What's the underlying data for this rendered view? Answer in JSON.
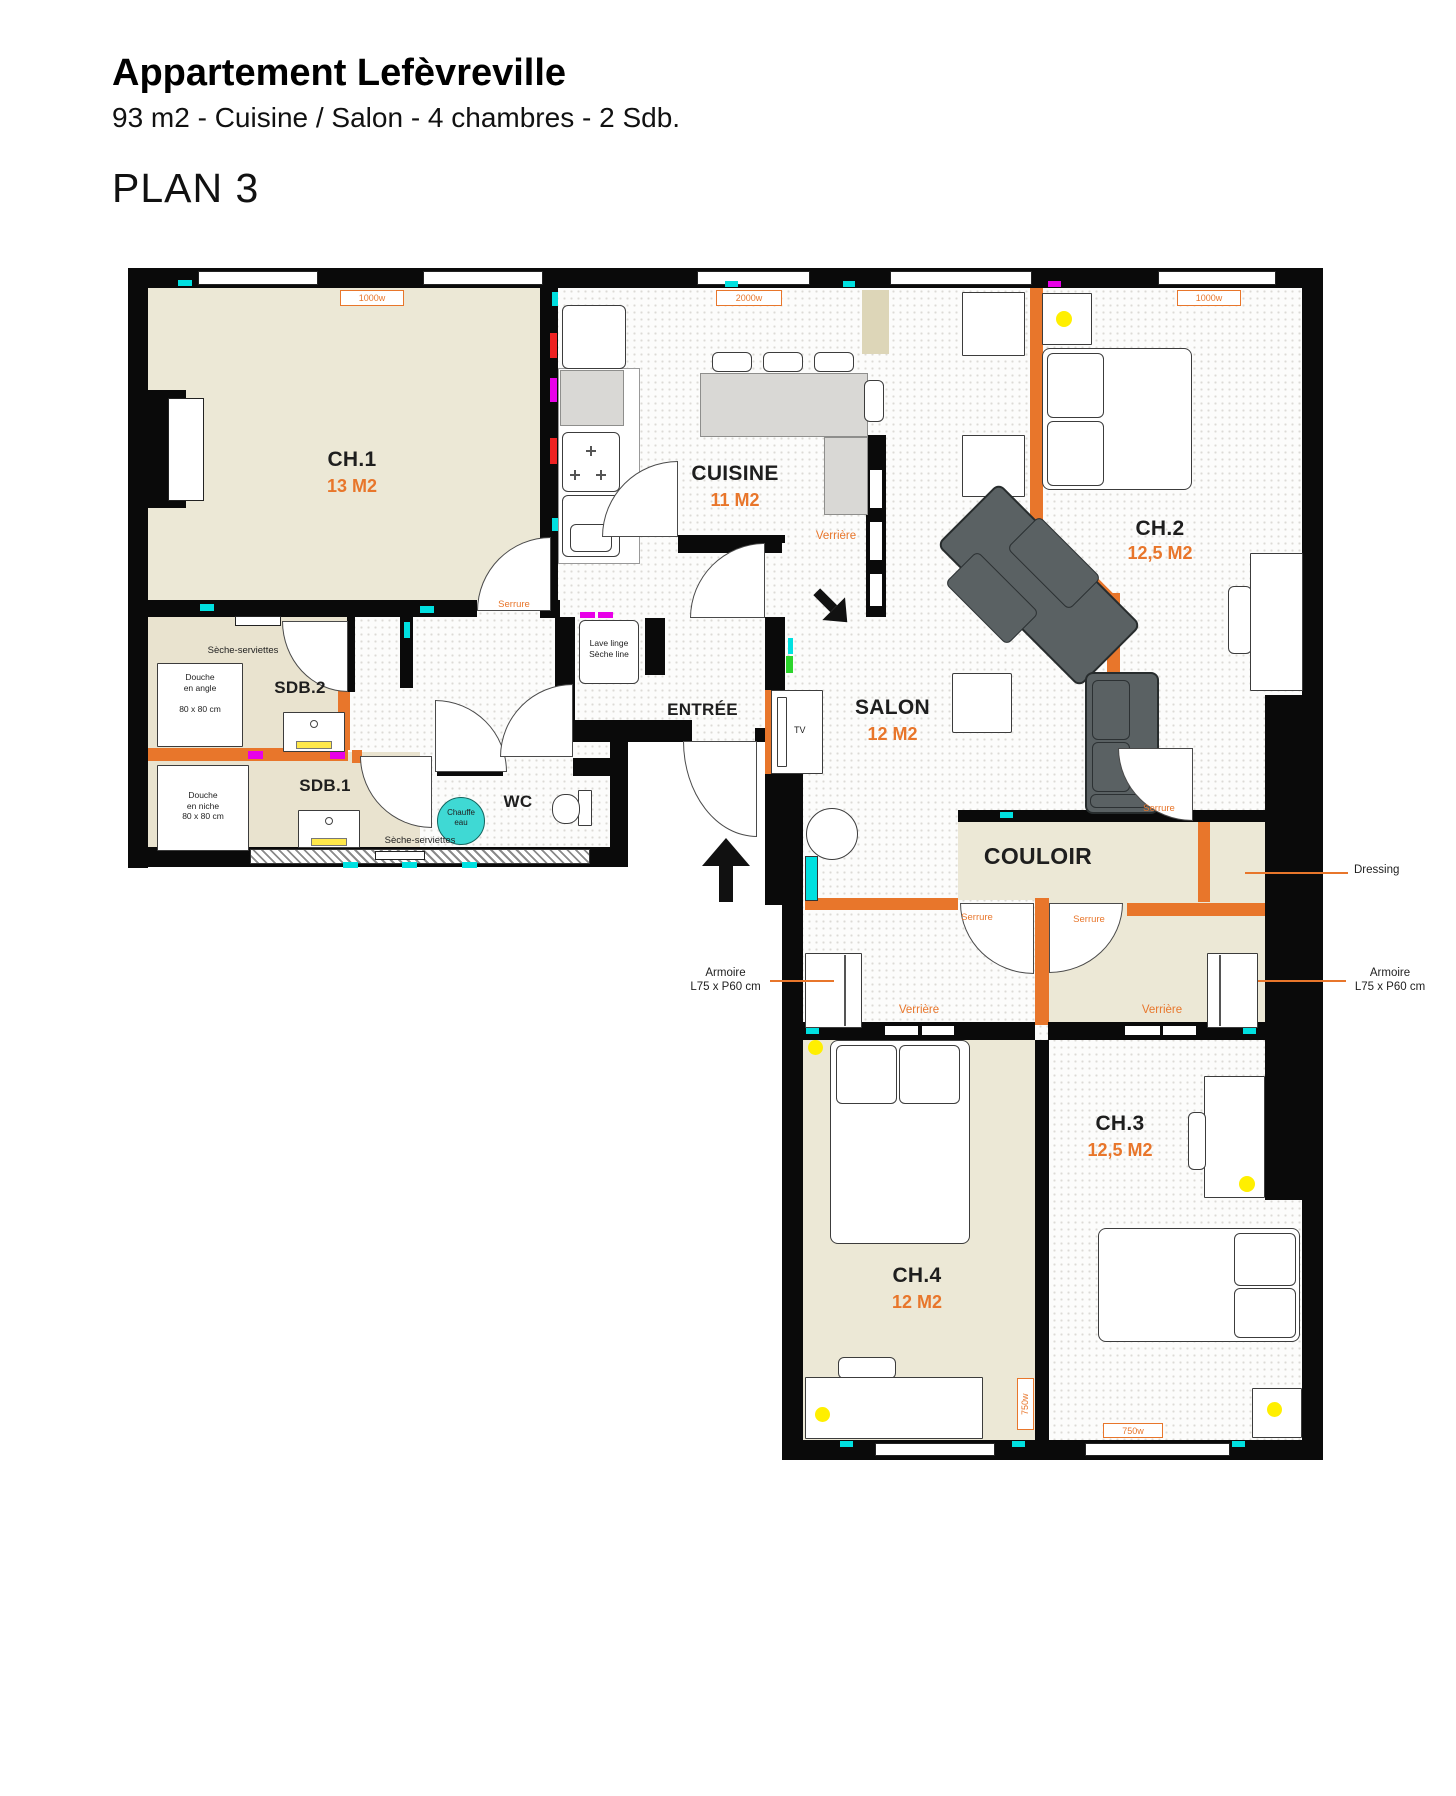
{
  "header": {
    "title": "Appartement Lefèvreville",
    "subtitle": "93 m2 - Cuisine / Salon - 4 chambres - 2 Sdb.",
    "plan": "PLAN 3"
  },
  "rooms": {
    "ch1": {
      "name": "CH.1",
      "area": "13 M2"
    },
    "cuisine": {
      "name": "CUISINE",
      "area": "11 M2"
    },
    "ch2": {
      "name": "CH.2",
      "area": "12,5 M2"
    },
    "salon": {
      "name": "SALON",
      "area": "12 M2"
    },
    "entree": {
      "name": "ENTRÉE"
    },
    "sdb2": {
      "name": "SDB.2"
    },
    "sdb1": {
      "name": "SDB.1"
    },
    "wc": {
      "name": "WC"
    },
    "couloir": {
      "name": "COULOIR"
    },
    "ch3": {
      "name": "CH.3",
      "area": "12,5 M2"
    },
    "ch4": {
      "name": "CH.4",
      "area": "12 M2"
    }
  },
  "heaters": {
    "ch1": "1000w",
    "cuisine": "2000w",
    "ch2": "1000w",
    "ch4": "750w",
    "ch3": "750w"
  },
  "labels": {
    "serrure": "Serrure",
    "verriere": "Verrière",
    "tv": "TV",
    "dressing": "Dressing",
    "armoire": "Armoire\nL75 x P60 cm",
    "seche_serviettes": "Sèche-serviettes",
    "chauffe_eau": "Chauffe\neau",
    "lave_linge": "Lave linge\nSèche line",
    "douche_angle": "Douche\nen angle\n\n80 x 80 cm",
    "douche_niche": "Douche\nen niche\n80 x 80 cm"
  },
  "colors": {
    "accent_orange": "#E8762B",
    "wall_black": "#0A0A0A",
    "room_beige": "#ECE8D6",
    "floor_white": "#FCFCFB",
    "tick_cyan": "#00E0E0",
    "tick_magenta": "#E800E8",
    "tick_red": "#EE2222",
    "tick_green": "#2BD42B",
    "light_yellow": "#FFEF00",
    "sofa_gray": "#5A6163",
    "water_heater_turquoise": "#3FD9D4"
  }
}
